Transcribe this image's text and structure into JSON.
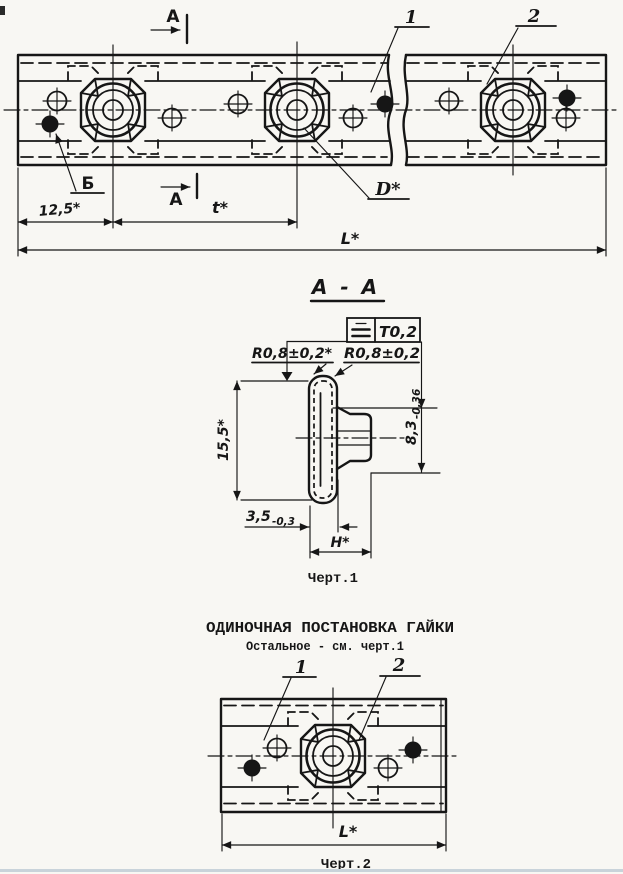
{
  "drawing": {
    "plan_view": {
      "section_arrow_top": "А",
      "section_arrow_bottom": "А",
      "callout_1": "1",
      "callout_2": "2",
      "hole_label": "Б",
      "dim_offset": "12,5*",
      "dim_pitch": "t*",
      "dim_length": "L*",
      "dim_diameter": "D*"
    },
    "section_view": {
      "title": "А - А",
      "tolerance_frame": {
        "symbol_icon": "parallelism",
        "value": "T0,2"
      },
      "radius_left": "R0,8±0,2*",
      "radius_right": "R0,8±0,2",
      "dim_height": "15,5*",
      "dim_depth": {
        "value": "8,3",
        "tolerance": "-0,36"
      },
      "dim_thickness": {
        "value": "3,5",
        "tolerance": "-0,3"
      },
      "dim_nut_height": "H*",
      "caption": "Черт.1"
    },
    "single_view": {
      "title": "ОДИНОЧНАЯ ПОСТАНОВКА ГАЙКИ",
      "subtitle": "Остальное - см. черт.1",
      "callout_1": "1",
      "callout_2": "2",
      "dim_length": "L*",
      "caption": "Черт.2"
    },
    "colors": {
      "ink": "#161616",
      "paper": "#f8f7f3",
      "scan_edge": "#c9d3da"
    }
  }
}
